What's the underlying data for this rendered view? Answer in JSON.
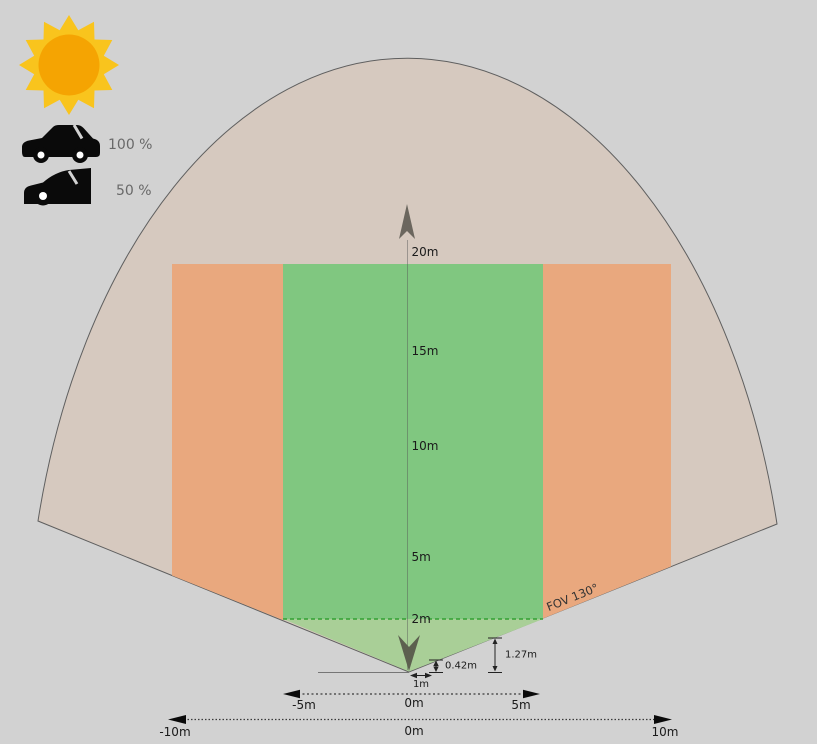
{
  "legend": {
    "full_visibility": "100 %",
    "half_visibility": "50 %"
  },
  "range_labels": [
    "20m",
    "15m",
    "10m",
    "5m",
    "2m"
  ],
  "fov_label": "FOV 130°",
  "measurements": {
    "offset_width": "1m",
    "near_height": "0.42m",
    "far_height": "1.27m"
  },
  "inner_axis": {
    "min": "-5m",
    "center": "0m",
    "max": "5m"
  },
  "outer_axis": {
    "min": "-10m",
    "center": "0m",
    "max": "10m"
  },
  "colors": {
    "background": "#d2d2d2",
    "cone-fill": "#d6c9bf",
    "cone-stroke": "#5f5f5f",
    "occluded-fill": "#e9a87e",
    "clear-fill": "#80c780",
    "near-fill": "#a9cf97",
    "boundary-line": "#33a033",
    "north-arrow": "#6b665e",
    "sensor-arrow": "#5c604f",
    "sun-rays": "#f9c41d",
    "sun-core": "#f5a402",
    "icon-fill": "#0a0a0a",
    "legend-text": "#696969",
    "label-text": "#1a1a1a",
    "measure-line": "#222222"
  }
}
